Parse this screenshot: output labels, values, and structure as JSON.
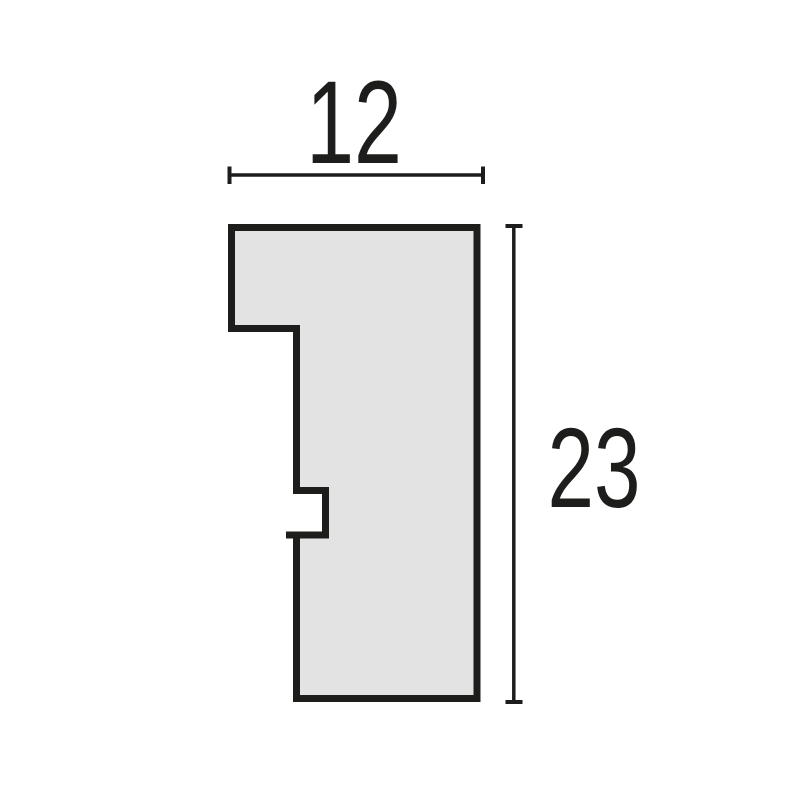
{
  "diagram": {
    "kind": "profile-cross-section-dimension-drawing",
    "background_color": "#ffffff",
    "profile": {
      "fill": "#e3e3e3",
      "outline_color": "#1d1d1b",
      "outline_width_px": 7,
      "points_svg": "231.5,227.5 477,227.5 477,698.5 296.5,698.5 296.5,535 325.5,535 325.5,490.5 296.5,490.5 296.5,328.5 231.5,328.5",
      "features": [
        "wide top flange (upper-left step, 230-297px wide band from y 225 to y 329)",
        "main vertical body on the right from x 296 to x 481",
        "small rectangular notch cut into left edge between y 490 and y 535, depth to x 325",
        "notch bottom lip line overshoots slightly left of the body edge"
      ]
    },
    "width_dimension": {
      "label": "12",
      "orientation": "horizontal",
      "line_y": 175,
      "from_x": 229.5,
      "to_x": 483,
      "color": "#1d1d1b"
    },
    "height_dimension": {
      "label": "23",
      "orientation": "vertical",
      "line_x": 513.8,
      "from_y": 226,
      "to_y": 702,
      "color": "#1d1d1b"
    }
  }
}
